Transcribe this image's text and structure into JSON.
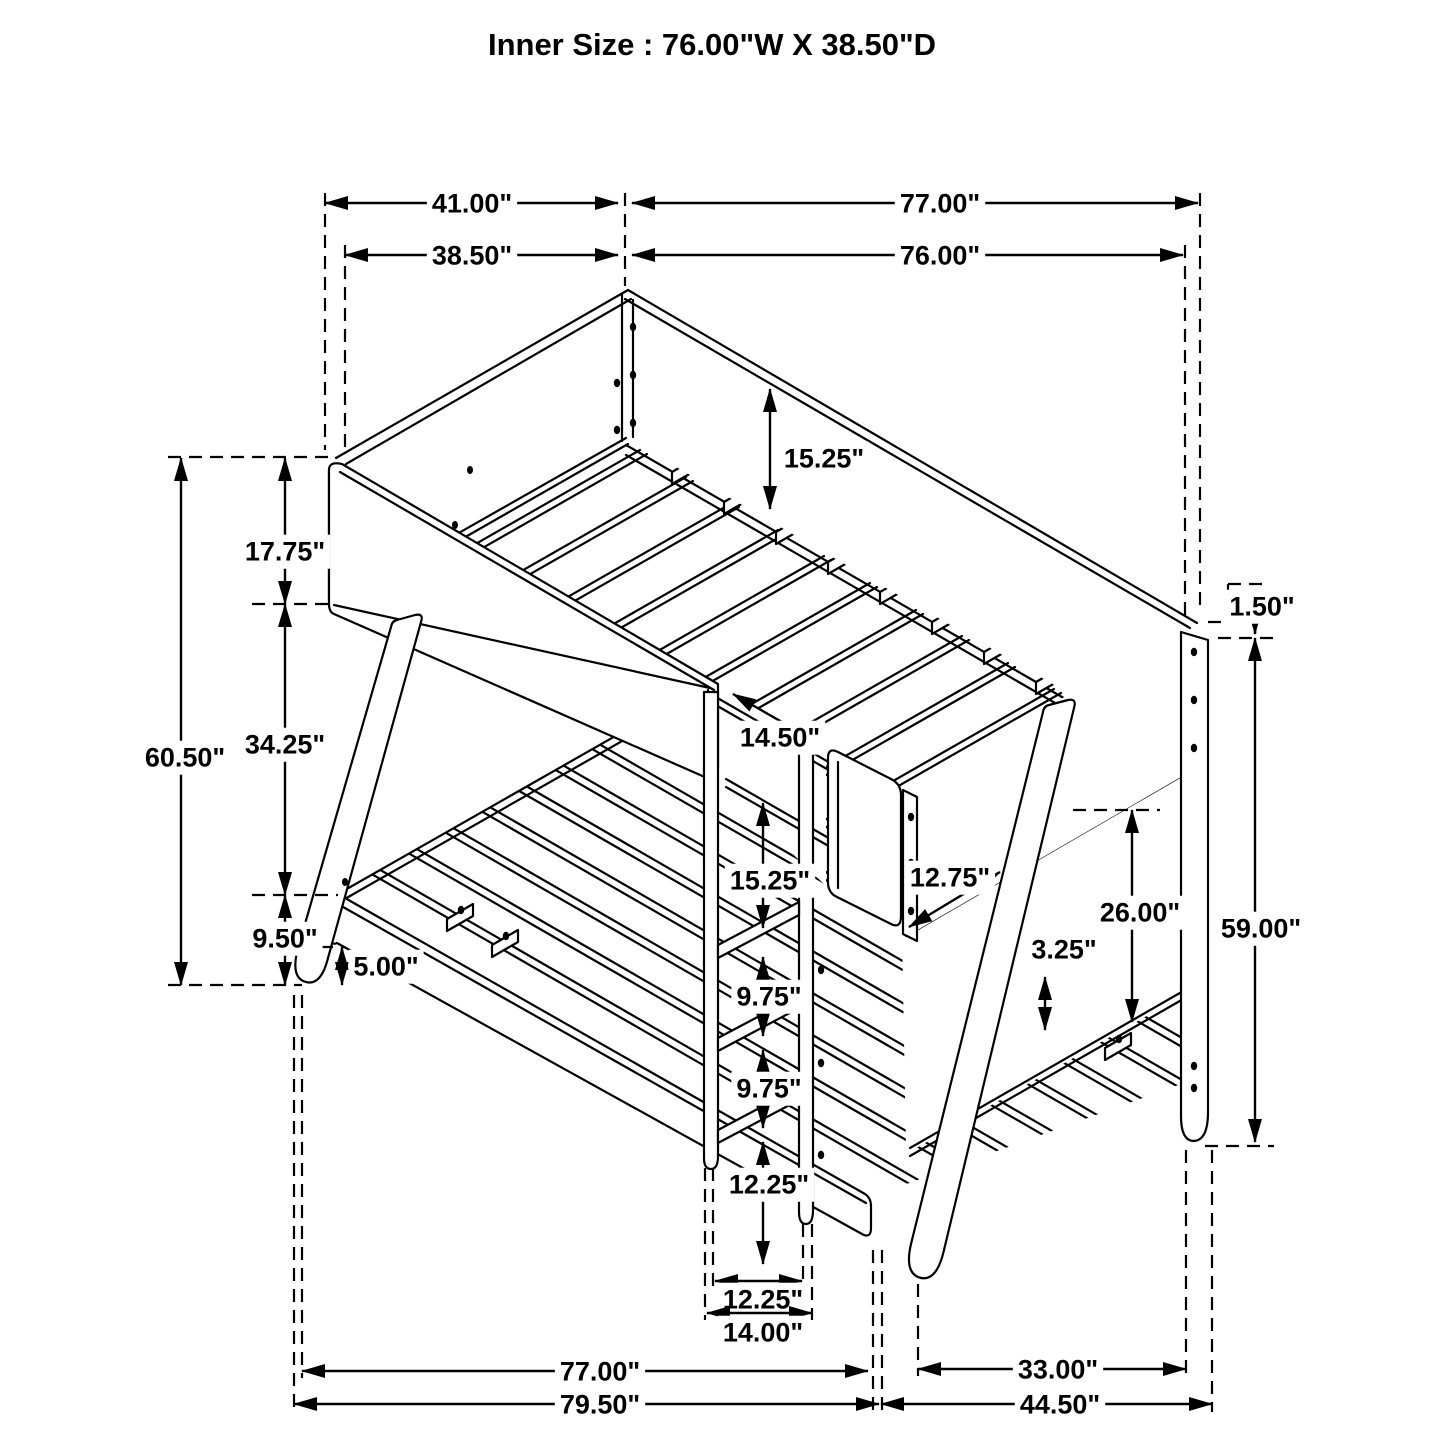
{
  "title": "Inner Size : 76.00\"W X  38.50\"D",
  "dims": {
    "top_outer_width": "41.00\"",
    "top_outer_length": "77.00\"",
    "top_inner_width": "38.50\"",
    "top_inner_length": "76.00\"",
    "overall_height": "60.50\"",
    "upper_rail_height": "17.75\"",
    "bunk_gap_height": "34.25\"",
    "lower_frame_height": "9.50\"",
    "floor_clearance": "5.00\"",
    "upper_rail_depth": "15.25\"",
    "ladder_opening_width": "14.50\"",
    "ladder_top_spacing": "15.25\"",
    "guard_rail_offset": "12.75\"",
    "lower_end_panel_height": "26.00\"",
    "slat_support_height": "3.25\"",
    "top_rail_lip": "1.50\"",
    "right_side_height": "59.00\"",
    "rung_spacing_upper": "9.75\"",
    "rung_spacing_lower": "9.75\"",
    "ladder_lower_section": "12.25\"",
    "ladder_feet_span": "12.25\"",
    "ladder_overall_width": "14.00\"",
    "base_length": "77.00\"",
    "base_overall_length": "79.50\"",
    "base_depth": "33.00\"",
    "base_overall_depth": "44.50\""
  }
}
